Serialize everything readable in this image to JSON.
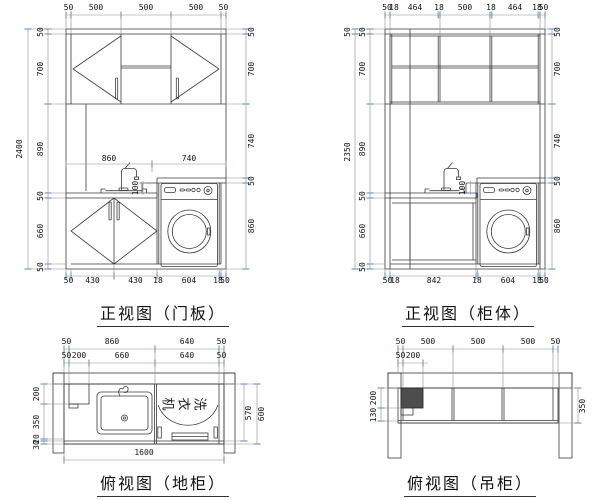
{
  "views": {
    "front_door": {
      "title": "正视图（门板）",
      "dims": {
        "top": [
          "50",
          "500",
          "500",
          "500",
          "50"
        ],
        "left_outer": [
          "2400"
        ],
        "left_inner": [
          "50",
          "700",
          "890",
          "50",
          "660",
          "50"
        ],
        "right": [
          "50",
          "700",
          "740",
          "50",
          "860"
        ],
        "mid": [
          "860",
          "740"
        ],
        "splash": "100",
        "bottom": [
          "50",
          "430",
          "430",
          "18",
          "604",
          "18",
          "50"
        ]
      }
    },
    "front_carcass": {
      "title": "正视图（柜体）",
      "dims": {
        "top": [
          "50",
          "18",
          "464",
          "18",
          "500",
          "18",
          "464",
          "18",
          "50"
        ],
        "left_outer": [
          "50",
          "2350"
        ],
        "left_inner": [
          "50",
          "700",
          "890",
          "50",
          "660",
          "50"
        ],
        "right": [
          "50",
          "700",
          "740",
          "50",
          "860"
        ],
        "splash": "100",
        "bottom": [
          "50",
          "18",
          "842",
          "18",
          "604",
          "18",
          "50"
        ]
      }
    },
    "plan_base": {
      "title": "俯视图（地柜）",
      "washer_label_chars": [
        "机",
        "衣",
        "洗"
      ],
      "dims": {
        "top_row1": [
          "50",
          "860",
          "640",
          "50"
        ],
        "top_row2": [
          "50",
          "200",
          "660",
          "640",
          "50"
        ],
        "left": [
          "200",
          "350",
          "20",
          "30"
        ],
        "right": [
          "570",
          "600"
        ],
        "bottom": [
          "1600"
        ]
      }
    },
    "plan_wall": {
      "title": "俯视图（吊柜）",
      "dims": {
        "top_row1": [
          "50",
          "500",
          "500",
          "500",
          "50"
        ],
        "top_row2": [
          "50",
          "200"
        ],
        "left": [
          "200",
          "130"
        ],
        "right": [
          "350"
        ]
      }
    }
  },
  "colors": {
    "line": "#3a3a3a",
    "tick": "#7b9cc4",
    "duct_fill": "#4d4d4d"
  }
}
